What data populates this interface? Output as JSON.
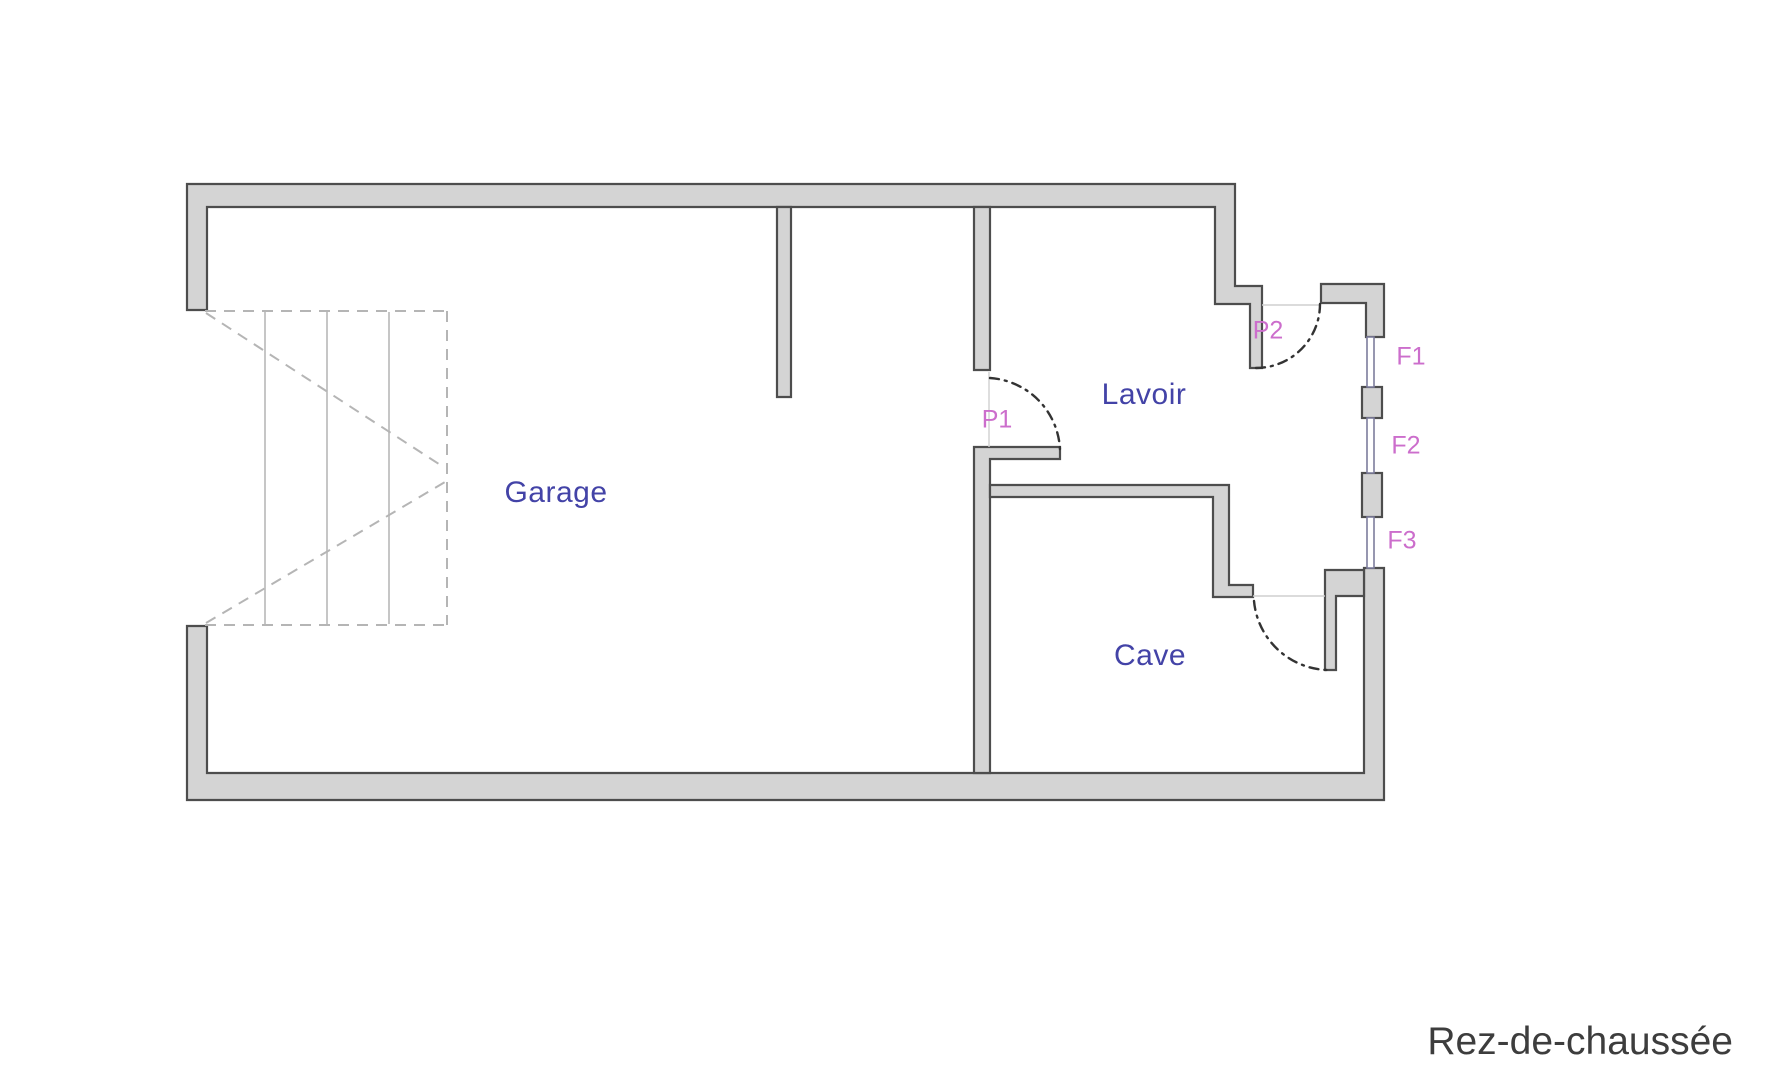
{
  "floor": {
    "title": "Rez-de-chaussée"
  },
  "rooms": [
    {
      "name": "Garage"
    },
    {
      "name": "Lavoir"
    },
    {
      "name": "Cave"
    }
  ],
  "doors": [
    {
      "id": "P1"
    },
    {
      "id": "P2"
    }
  ],
  "windows": [
    {
      "id": "F1"
    },
    {
      "id": "F2"
    },
    {
      "id": "F3"
    }
  ],
  "icons": {
    "stairs": "stairs-symbol",
    "door_swing": "door-swing-arc",
    "window": "window-double-line"
  },
  "colors": {
    "background": "#ffffff",
    "wall_fill": "#d4d4d4",
    "wall_stroke": "#4d4d4d",
    "window_stroke": "#7d7d9c",
    "door_arc": "#333333",
    "stair_line": "#c6c6c6",
    "stair_dash": "#b5b5b5",
    "threshold_line": "#cfcfcf",
    "room_label": "#4343a7",
    "opening_label": "#cc6ecc",
    "floor_title": "#3d3d3d"
  }
}
